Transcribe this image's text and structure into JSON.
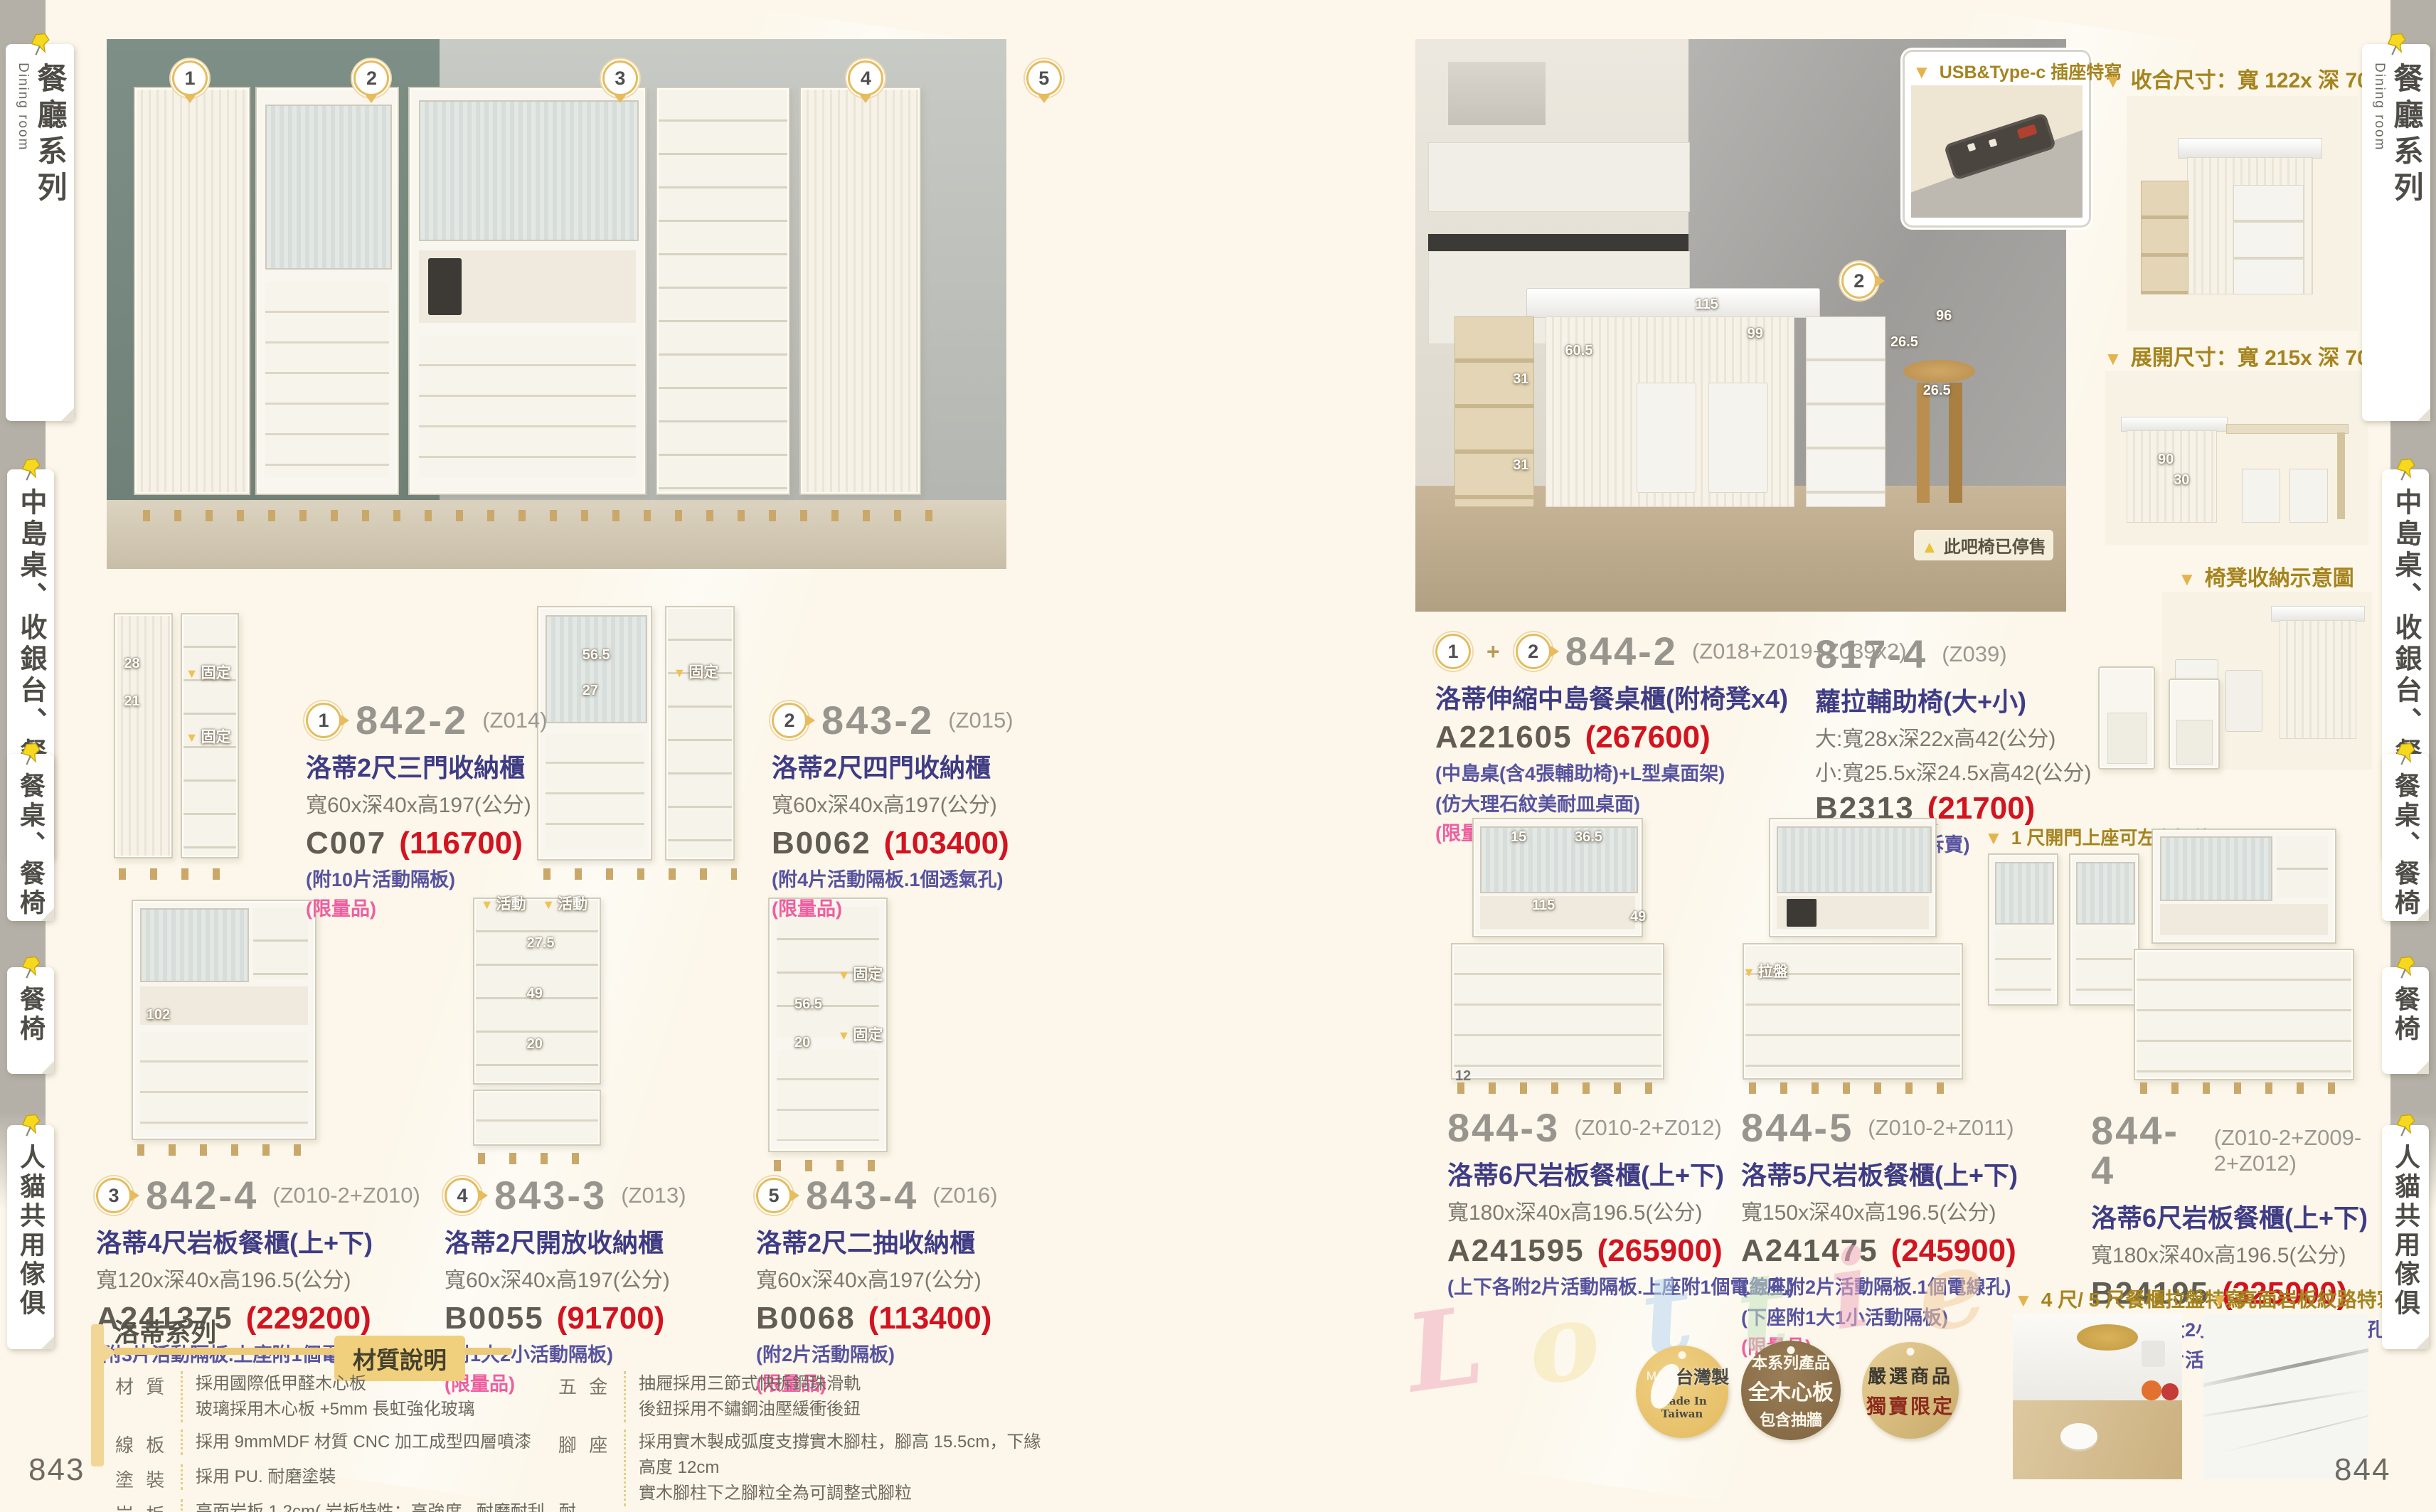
{
  "sidebar": {
    "items": [
      {
        "label": "餐廳系列",
        "sub": "Dining room"
      },
      {
        "label": "中島桌、收銀台、餐櫃"
      },
      {
        "label": "餐桌、餐椅"
      },
      {
        "label": "餐椅"
      },
      {
        "label": "人貓共用傢俱"
      }
    ]
  },
  "left_page": {
    "page_number": "843",
    "hero_markers": [
      "1",
      "2",
      "3",
      "4",
      "5"
    ],
    "products": [
      {
        "marker": "1",
        "code": "842-2",
        "variant": "(Z014)",
        "name": "洛蒂2尺三門收納櫃",
        "size": "寬60x深40x高197(公分)",
        "model": "C007",
        "price": "(116700)",
        "note1": "(附10片活動隔板)",
        "limited": "(限量品)"
      },
      {
        "marker": "2",
        "code": "843-2",
        "variant": "(Z015)",
        "name": "洛蒂2尺四門收納櫃",
        "size": "寬60x深40x高197(公分)",
        "model": "B0062",
        "price": "(103400)",
        "note1": "(附4片活動隔板.1個透氣孔)",
        "limited": "(限量品)"
      },
      {
        "marker": "3",
        "code": "842-4",
        "variant": "(Z010-2+Z010)",
        "name": "洛蒂4尺岩板餐櫃(上+下)",
        "size": "寬120x深40x高196.5(公分)",
        "model": "A241375",
        "price": "(229200)",
        "note1": "(附3片活動隔板.上座附1個電線孔)"
      },
      {
        "marker": "4",
        "code": "843-3",
        "variant": "(Z013)",
        "name": "洛蒂2尺開放收納櫃",
        "size": "寬60x深40x高197(公分)",
        "model": "B0055",
        "price": "(91700)",
        "note1": "(附1大2小活動隔板)",
        "limited": "(限量品)"
      },
      {
        "marker": "5",
        "code": "843-4",
        "variant": "(Z016)",
        "name": "洛蒂2尺二抽收納櫃",
        "size": "寬60x深40x高197(公分)",
        "model": "B0068",
        "price": "(113400)",
        "note1": "(附2片活動隔板)",
        "limited": "(限量品)"
      }
    ],
    "figs": {
      "f1": [
        "28",
        "21",
        "固定",
        "固定"
      ],
      "f2": [
        "56.5",
        "27",
        "固定"
      ],
      "f3": [
        "102"
      ],
      "f4": [
        "活動",
        "活動",
        "27.5",
        "49",
        "20"
      ],
      "f5": [
        "56.5",
        "固定",
        "20",
        "固定"
      ]
    },
    "series": {
      "title": "洛蒂系列",
      "spec_badge": "材質說明",
      "rows": [
        {
          "label": "材 質",
          "lines": [
            "採用國際低甲醛木心板",
            "玻璃採用木心板 +5mm 長虹強化玻璃"
          ]
        },
        {
          "label": "線 板",
          "lines": [
            "採用 9mmMDF 材質 CNC 加工成型四層噴漆"
          ]
        },
        {
          "label": "塗 裝",
          "lines": [
            "採用 PU. 耐磨塗裝"
          ]
        },
        {
          "label": "岩 板",
          "lines": [
            "亮面岩板 1.2cm( 岩板特性：高強度 . 耐磨耐刮 . 耐高溫 . 易清潔 )"
          ]
        },
        {
          "label": "五 金",
          "lines": [
            "抽屜採用三節式快拆鋼珠滑軌",
            "後鈕採用不鏽鋼油壓緩衝後鈕"
          ]
        },
        {
          "label": "腳 座",
          "lines": [
            "採用實木製成弧度支撐實木腳柱，腳高 15.5cm，下緣高度 12cm",
            "實木腳柱下之腳粒全為可調整式腳粒"
          ]
        },
        {
          "label": "背 板",
          "lines": [
            "採用美背處理"
          ]
        }
      ]
    }
  },
  "right_page": {
    "page_number": "844",
    "usb_callout": "USB&Type-c 插座特寫",
    "fold_size": "收合尺寸：寬 122x 深 70x 高 95cm",
    "open_size": "展開尺寸：寬 215x 深 70x 高 95cm",
    "stool_note": "椅凳收納示意圖",
    "discontinued": "此吧椅已停售",
    "swing_note": "1 尺開門上座可左右擺放",
    "detail1": "4 尺/ 5 尺餐櫃拉盤特寫",
    "detail2": "亮面岩板紋路特寫",
    "watermark": [
      "L",
      "o",
      "t",
      "t",
      "i",
      "e"
    ],
    "kitchen_markers": [
      "1",
      "2"
    ],
    "figs": {
      "kitchen": [
        "115",
        "99",
        "96",
        "26.5",
        "26.5",
        "60.5",
        "31",
        "31"
      ],
      "open": [
        "90",
        "30"
      ],
      "g1": [
        "15",
        "36.5",
        "115",
        "49",
        "12"
      ],
      "g2": [
        "拉盤"
      ]
    },
    "products": [
      {
        "marker1": "1",
        "plus": "+",
        "marker2": "2",
        "code": "844-2",
        "variant": "(Z018+Z019+Z039x2)",
        "name": "洛蒂伸縮中島餐桌櫃(附椅凳x4)",
        "model": "A221605",
        "price": "(267600)",
        "note1": "(中島桌(含4張輔助椅)+L型桌面架)",
        "note2": "(仿大理石紋美耐皿桌面)",
        "limited": "(限量品)"
      },
      {
        "code": "817-4",
        "variant": "(Z039)",
        "name": "蘿拉輔助椅(大+小)",
        "size1": "大:寬28x深22x高42(公分)",
        "size2": "小:寬25.5x深24.5x高42(公分)",
        "model": "B2313",
        "price": "(21700)",
        "note1": "(2張1組.恕不拆賣)"
      },
      {
        "code": "844-3",
        "variant": "(Z010-2+Z012)",
        "name": "洛蒂6尺岩板餐櫃(上+下)",
        "size": "寬180x深40x高196.5(公分)",
        "model": "A241595",
        "price": "(265900)",
        "note1": "(上下各附2片活動隔板.上座附1個電線孔)"
      },
      {
        "code": "844-5",
        "variant": "(Z010-2+Z011)",
        "name": "洛蒂5尺岩板餐櫃(上+下)",
        "size": "寬150x深40x高196.5(公分)",
        "model": "A241475",
        "price": "(245900)",
        "note1": "(上座附2片活動隔板.1個電線孔)",
        "note2": "(下座附1大1小活動隔板)",
        "limited": "(限量品)"
      },
      {
        "code": "844-4",
        "variant": "(Z010-2+Z009-2+Z012)",
        "name": "洛蒂6尺岩板餐櫃(上+下)",
        "size": "寬180x深40x高196.5(公分)",
        "model": "B24195",
        "price": "(325000)",
        "note1": "(上座附2大2小活動隔板.1個電線孔)",
        "note2": "(下座附2片活動隔板)"
      }
    ],
    "badges": [
      {
        "line1": "MIT",
        "line2": "台灣製",
        "line3": "Made In Taiwan"
      },
      {
        "line1": "本系列產品",
        "line2": "全木心板",
        "line3": "包含抽牆"
      },
      {
        "line1": "嚴選商品",
        "line2": "獨賣限定"
      }
    ]
  }
}
